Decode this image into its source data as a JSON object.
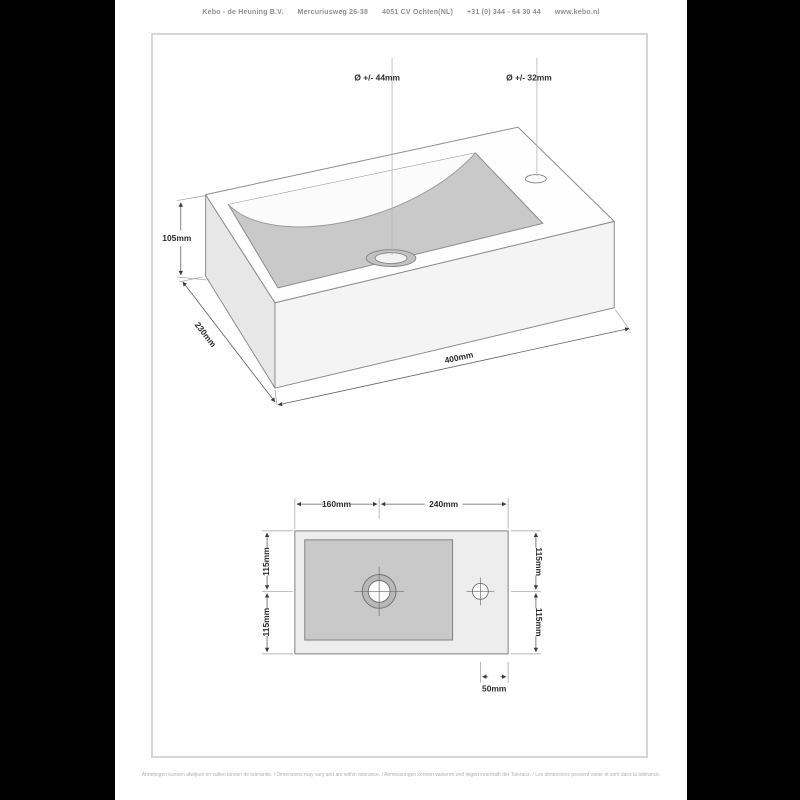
{
  "header": {
    "company": "Kebo - de Heuning B.V.",
    "address": "Mercuriusweg 26-38",
    "city": "4051 CV Ochten(NL)",
    "phone": "+31 (0) 344 - 64 30 44",
    "website": "www.kebo.nl"
  },
  "iso_view": {
    "drain_diameter_label": "Ø +/- 44mm",
    "faucet_diameter_label": "Ø +/- 32mm",
    "height_label": "105mm",
    "depth_label": "230mm",
    "width_label": "400mm"
  },
  "top_view": {
    "basin_width_label": "160mm",
    "tap_side_width_label": "240mm",
    "left_depth_top_label": "115mm",
    "left_depth_bottom_label": "115mm",
    "right_depth_top_label": "115mm",
    "right_depth_bottom_label": "115mm",
    "faucet_offset_label": "50mm"
  },
  "footer": {
    "disclaimer": "Afmetingen kunnen afwijken en vallen binnen de tolerantie. / Dimensions may vary and are within tolerance. / Abmessungen können variieren und liegen innerhalb der Toleranz. / Les dimensions peuvent varier et sont dans la tolérance."
  },
  "colors": {
    "side_bars": "#000000",
    "page_background": "#ffffff",
    "frame_border": "#d6d6d6",
    "edge_lines": "#8c8c8c",
    "basin_gray": "#c9c9c9",
    "left_face_gray": "#e7e7e7",
    "front_face_gray": "#f4f4f4",
    "dimension_text": "#2b2b2b",
    "header_text": "#8f8f8f",
    "footer_text": "#b0b0b0"
  }
}
